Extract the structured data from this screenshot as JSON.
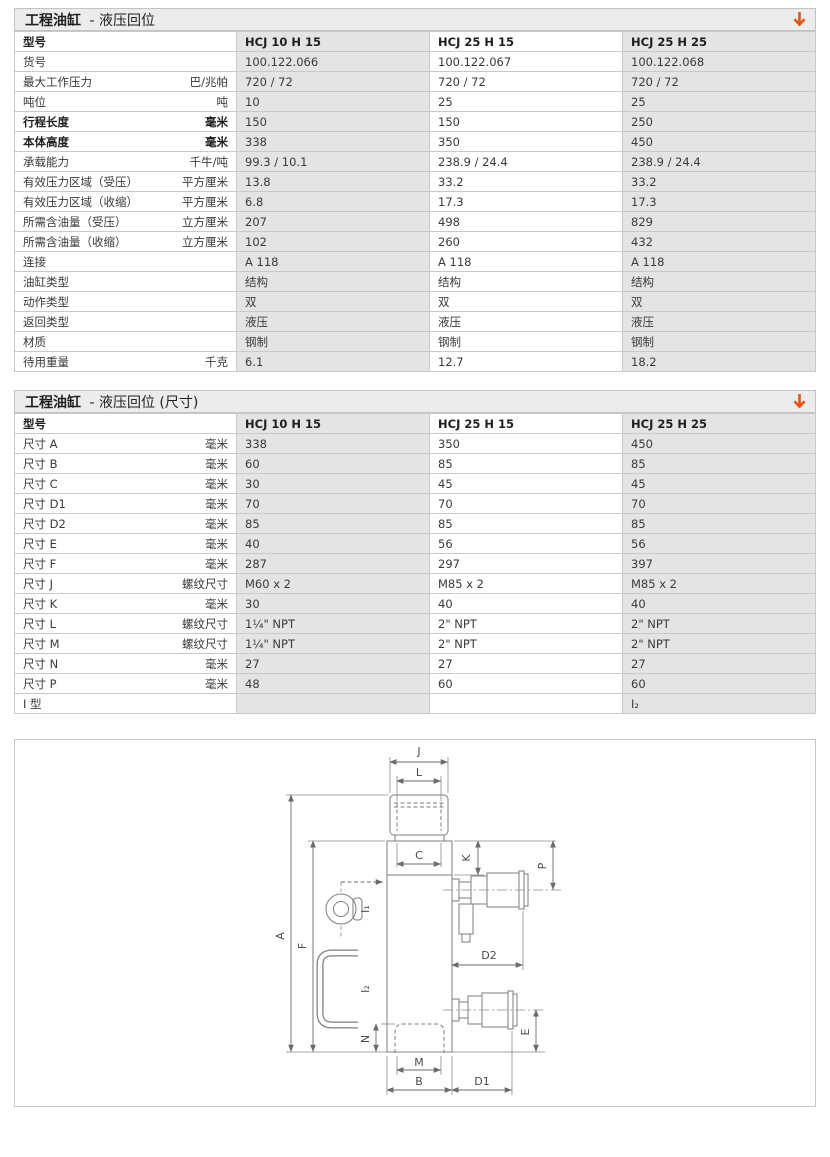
{
  "colors": {
    "accent": "#e8530e",
    "cell_gray": "#e4e4e4",
    "titlebar_gray": "#ececec"
  },
  "table1": {
    "title_bold": "工程油缸",
    "title_rest": "- 液压回位",
    "model_label": "型号",
    "columns": [
      "HCJ 10 H 15",
      "HCJ 25 H 15",
      "HCJ 25 H 25"
    ],
    "rows": [
      {
        "label": "货号",
        "unit": "",
        "bold": false,
        "values": [
          "100.122.066",
          "100.122.067",
          "100.122.068"
        ]
      },
      {
        "label": "最大工作压力",
        "unit": "巴/兆帕",
        "bold": false,
        "values": [
          "720 / 72",
          "720 / 72",
          "720 / 72"
        ]
      },
      {
        "label": "吨位",
        "unit": "吨",
        "bold": false,
        "values": [
          "10",
          "25",
          "25"
        ]
      },
      {
        "label": "行程长度",
        "unit": "毫米",
        "bold": true,
        "values": [
          "150",
          "150",
          "250"
        ]
      },
      {
        "label": "本体高度",
        "unit": "毫米",
        "bold": true,
        "values": [
          "338",
          "350",
          "450"
        ]
      },
      {
        "label": "承载能力",
        "unit": "千牛/吨",
        "bold": false,
        "values": [
          "99.3 / 10.1",
          "238.9 / 24.4",
          "238.9 / 24.4"
        ]
      },
      {
        "label": "有效压力区域（受压）",
        "unit": "平方厘米",
        "bold": false,
        "values": [
          "13.8",
          "33.2",
          "33.2"
        ]
      },
      {
        "label": "有效压力区域（收缩）",
        "unit": "平方厘米",
        "bold": false,
        "values": [
          "6.8",
          "17.3",
          "17.3"
        ]
      },
      {
        "label": "所需含油量（受压）",
        "unit": "立方厘米",
        "bold": false,
        "values": [
          "207",
          "498",
          "829"
        ]
      },
      {
        "label": "所需含油量（收缩）",
        "unit": "立方厘米",
        "bold": false,
        "values": [
          "102",
          "260",
          "432"
        ]
      },
      {
        "label": "连接",
        "unit": "",
        "bold": false,
        "values": [
          "A 118",
          "A 118",
          "A 118"
        ]
      },
      {
        "label": "油缸类型",
        "unit": "",
        "bold": false,
        "values": [
          "结构",
          "结构",
          "结构"
        ]
      },
      {
        "label": "动作类型",
        "unit": "",
        "bold": false,
        "values": [
          "双",
          "双",
          "双"
        ]
      },
      {
        "label": "返回类型",
        "unit": "",
        "bold": false,
        "values": [
          "液压",
          "液压",
          "液压"
        ]
      },
      {
        "label": "材质",
        "unit": "",
        "bold": false,
        "values": [
          "钢制",
          "钢制",
          "钢制"
        ]
      },
      {
        "label": "待用重量",
        "unit": "千克",
        "bold": false,
        "values": [
          "6.1",
          "12.7",
          "18.2"
        ]
      }
    ]
  },
  "table2": {
    "title_bold": "工程油缸",
    "title_rest": "- 液压回位 (尺寸)",
    "model_label": "型号",
    "columns": [
      "HCJ 10 H 15",
      "HCJ 25 H 15",
      "HCJ 25 H 25"
    ],
    "rows": [
      {
        "label": "尺寸 A",
        "unit": "毫米",
        "bold": false,
        "values": [
          "338",
          "350",
          "450"
        ]
      },
      {
        "label": "尺寸 B",
        "unit": "毫米",
        "bold": false,
        "values": [
          "60",
          "85",
          "85"
        ]
      },
      {
        "label": "尺寸 C",
        "unit": "毫米",
        "bold": false,
        "values": [
          "30",
          "45",
          "45"
        ]
      },
      {
        "label": "尺寸 D1",
        "unit": "毫米",
        "bold": false,
        "values": [
          "70",
          "70",
          "70"
        ]
      },
      {
        "label": "尺寸 D2",
        "unit": "毫米",
        "bold": false,
        "values": [
          "85",
          "85",
          "85"
        ]
      },
      {
        "label": "尺寸 E",
        "unit": "毫米",
        "bold": false,
        "values": [
          "40",
          "56",
          "56"
        ]
      },
      {
        "label": "尺寸 F",
        "unit": "毫米",
        "bold": false,
        "values": [
          "287",
          "297",
          "397"
        ]
      },
      {
        "label": "尺寸 J",
        "unit": "螺纹尺寸",
        "bold": false,
        "values": [
          "M60 x 2",
          "M85 x 2",
          "M85 x 2"
        ]
      },
      {
        "label": "尺寸 K",
        "unit": "毫米",
        "bold": false,
        "values": [
          "30",
          "40",
          "40"
        ]
      },
      {
        "label": "尺寸 L",
        "unit": "螺纹尺寸",
        "bold": false,
        "values": [
          "1¼\" NPT",
          "2\" NPT",
          "2\" NPT"
        ]
      },
      {
        "label": "尺寸 M",
        "unit": "螺纹尺寸",
        "bold": false,
        "values": [
          "1¼\" NPT",
          "2\" NPT",
          "2\" NPT"
        ]
      },
      {
        "label": "尺寸 N",
        "unit": "毫米",
        "bold": false,
        "values": [
          "27",
          "27",
          "27"
        ]
      },
      {
        "label": "尺寸 P",
        "unit": "毫米",
        "bold": false,
        "values": [
          "48",
          "60",
          "60"
        ]
      },
      {
        "label": "I 型",
        "unit": "",
        "bold": false,
        "values": [
          "",
          "",
          "I₂"
        ]
      }
    ]
  },
  "diagram": {
    "labels": {
      "J": "J",
      "L": "L",
      "C": "C",
      "K": "K",
      "P": "P",
      "A": "A",
      "F": "F",
      "I1": "I₁",
      "I2": "I₂",
      "D2": "D2",
      "N": "N",
      "M": "M",
      "B": "B",
      "D1": "D1",
      "E": "E"
    }
  }
}
